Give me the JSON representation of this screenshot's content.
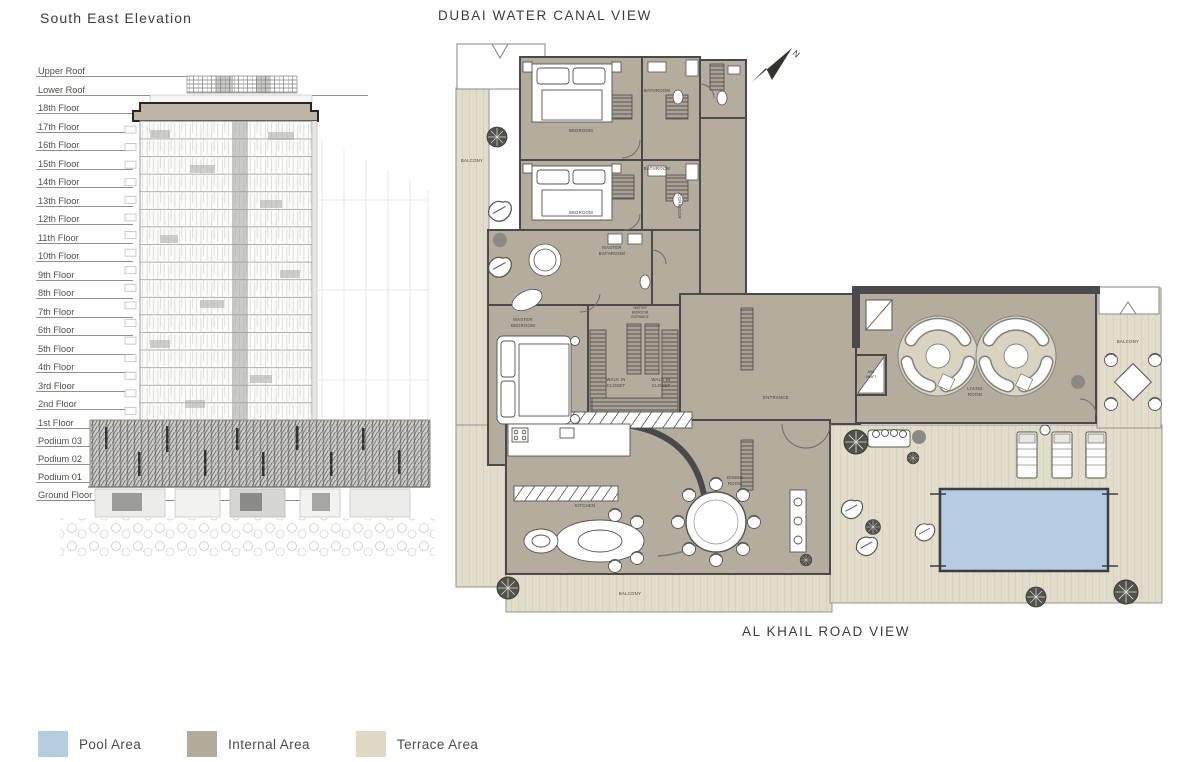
{
  "elevation": {
    "title": "South East Elevation",
    "floors": [
      "Upper Roof",
      "Lower Roof",
      "18th Floor",
      "17th Floor",
      "16th Floor",
      "15th Floor",
      "14th Floor",
      "13th Floor",
      "12th Floor",
      "11th Floor",
      "10th Floor",
      "9th Floor",
      "8th Floor",
      "7th Floor",
      "6th Floor",
      "5th Floor",
      "4th Floor",
      "3rd Floor",
      "2nd Floor",
      "1st Floor",
      "Podium 03",
      "Podium 02",
      "Podium 01",
      "Ground Floor"
    ]
  },
  "floorplan": {
    "top_title": "DUBAI WATER CANAL VIEW",
    "bottom_title": "AL KHAIL ROAD VIEW",
    "north_label": "N",
    "rooms": {
      "bedroom_1": [
        "BEDROOM"
      ],
      "bathroom_1": [
        "BATHROOM"
      ],
      "bedroom_2": [
        "BEDROOM"
      ],
      "bathroom_2": [
        "BATHROOM"
      ],
      "master_bathroom": [
        "MASTER",
        "BATHROOM"
      ],
      "corridor": [
        "CORRIDOR"
      ],
      "master_bedroom": [
        "MASTER",
        "BEDROOM"
      ],
      "master_bedroom_entrance": [
        "MASTER",
        "BEDROOM",
        "ENTRANCE"
      ],
      "walk_in_closet_1": [
        "WALK IN",
        "CLOSET"
      ],
      "walk_in_closet_2": [
        "WALK IN",
        "CLOSET"
      ],
      "entrance": [
        "ENTRANCE"
      ],
      "ahu_shaft": [
        "AHU",
        "SHAFT"
      ],
      "living_room": [
        "LIVING",
        "ROOM"
      ],
      "kitchen": [
        "KITCHEN"
      ],
      "dining_room": [
        "DINING",
        "ROOM"
      ],
      "balcony_left": [
        "BALCONY"
      ],
      "balcony_bottom": [
        "BALCONY"
      ],
      "balcony_right": [
        "BALCONY"
      ]
    }
  },
  "legend": {
    "items": [
      {
        "label": "Pool Area",
        "color": "#b5cde1"
      },
      {
        "label": "Internal Area",
        "color": "#b2ab9b"
      },
      {
        "label": "Terrace Area",
        "color": "#ded8c4"
      }
    ]
  },
  "colors": {
    "pool": "#b4cbe2",
    "internal": "#b4ad9e",
    "terrace": "#e2dcca",
    "walls": "#4a4a4c"
  }
}
